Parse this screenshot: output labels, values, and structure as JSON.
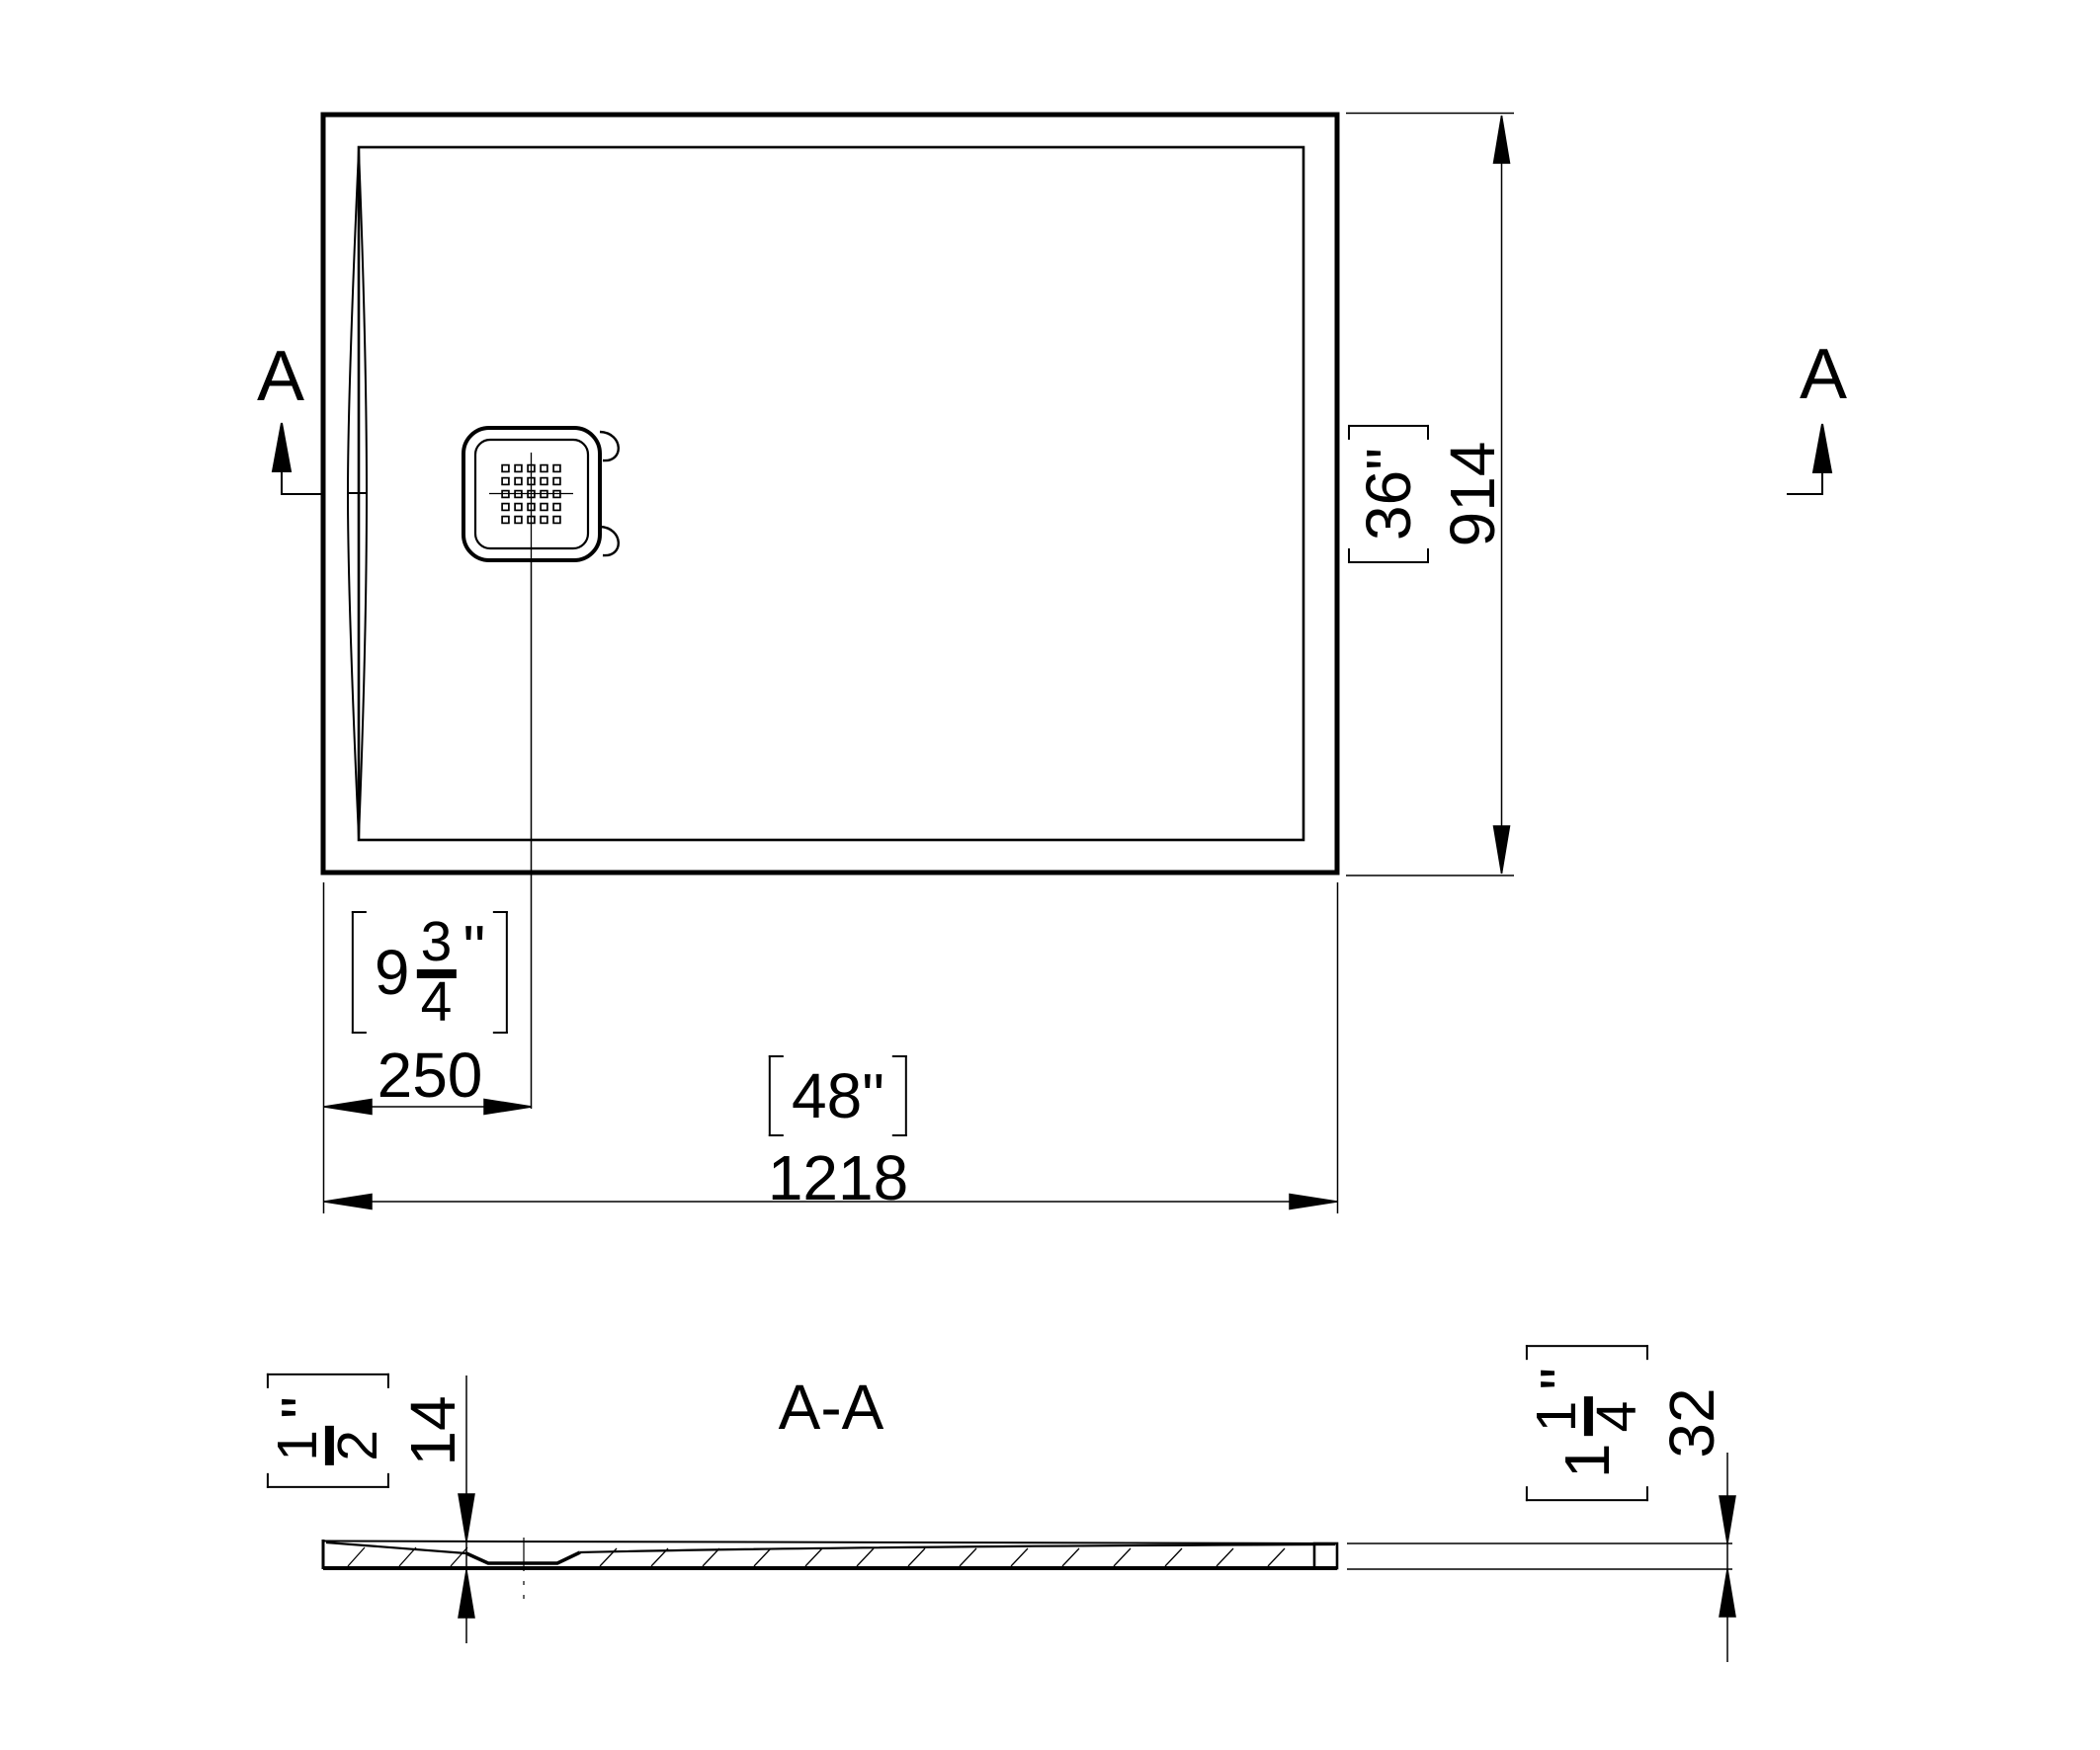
{
  "drawing_type": "shower-tray-technical-drawing",
  "section": {
    "letter": "A",
    "title": "A-A"
  },
  "dimensions": {
    "tray_width": {
      "imperial": "48\"",
      "metric": "1218"
    },
    "tray_depth": {
      "imperial": "36\"",
      "metric": "914"
    },
    "drain_offset": {
      "whole": "9",
      "numerator": "3",
      "denominator": "4",
      "unit": "\"",
      "metric": "250"
    },
    "min_thickness": {
      "numerator": "1",
      "denominator": "2",
      "unit": "\"",
      "metric": "14"
    },
    "edge_height": {
      "whole": "1",
      "numerator": "1",
      "denominator": "4",
      "unit": "\"",
      "metric": "32"
    }
  },
  "colors": {
    "line": "#000000",
    "background": "#ffffff"
  }
}
